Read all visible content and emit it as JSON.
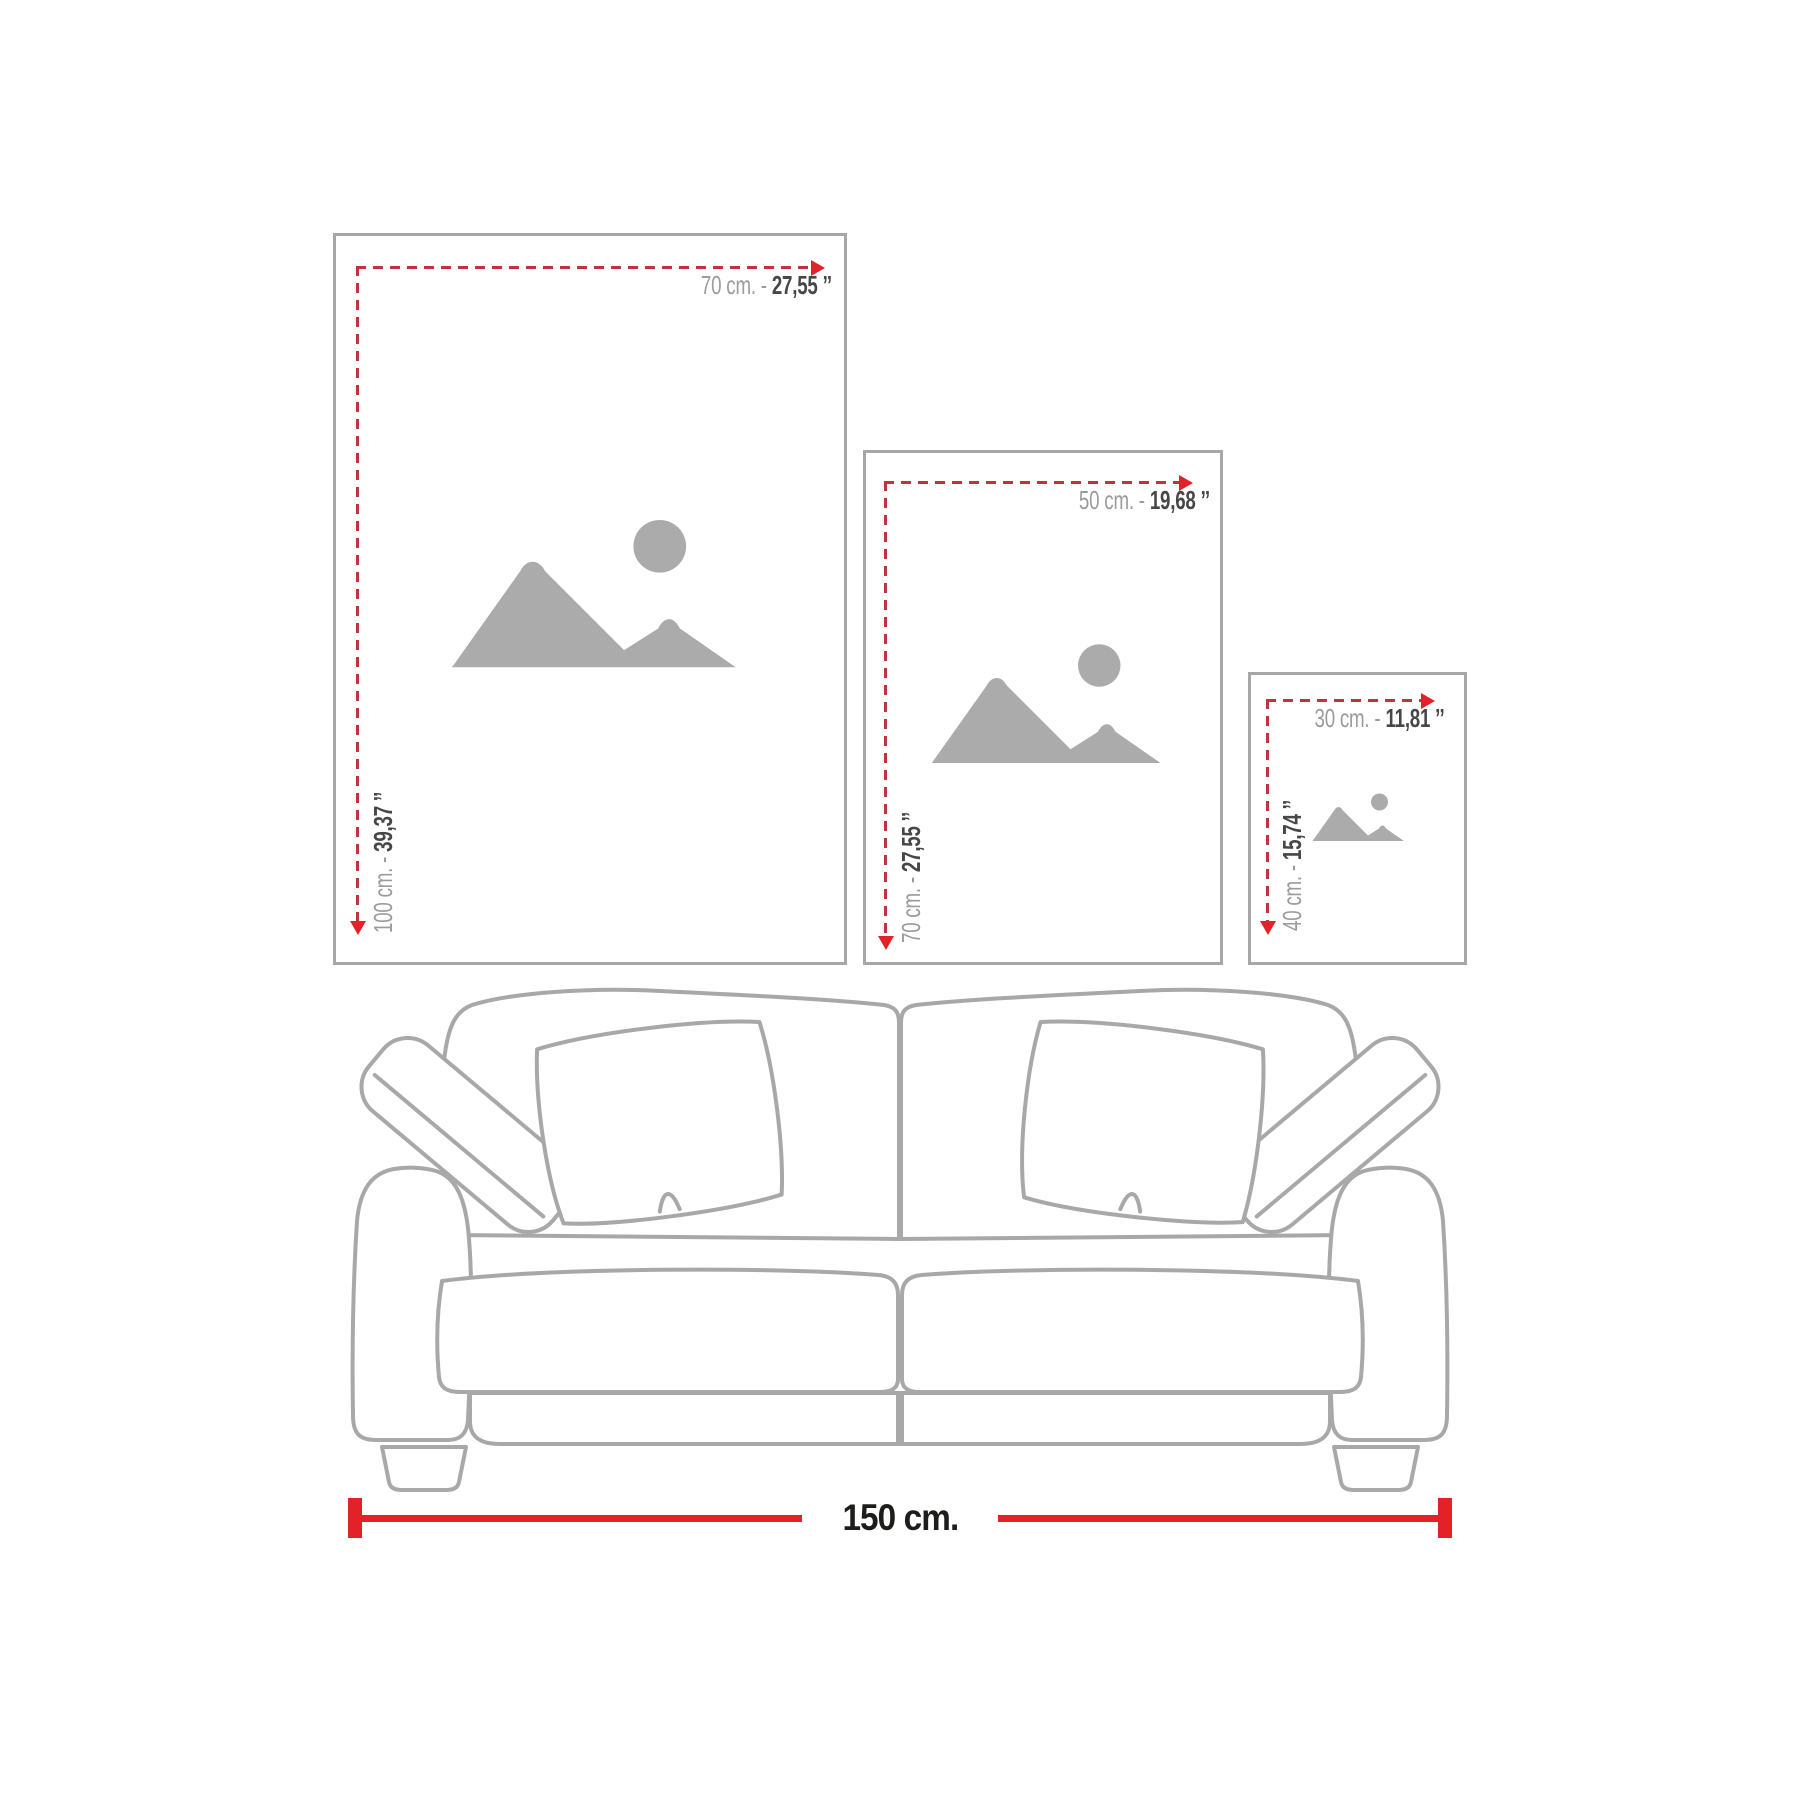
{
  "frames": [
    {
      "name": "frame-70x100",
      "width_cm": "70 cm. -",
      "width_in": "27,55 ’’",
      "height_cm": "100 cm. -",
      "height_in": "39,37 ’’"
    },
    {
      "name": "frame-50x70",
      "width_cm": "50 cm. -",
      "width_in": "19,68 ’’",
      "height_cm": "70 cm. -",
      "height_in": "27,55 ’’"
    },
    {
      "name": "frame-30x40",
      "width_cm": "30 cm. -",
      "width_in": "11,81 ’’",
      "height_cm": "40 cm. -",
      "height_in": "15,74 ’’"
    }
  ],
  "sofa": {
    "width_label": "150 cm."
  },
  "icons": {
    "placeholder": "image-placeholder-icon",
    "arrow_right": "arrow-right-icon",
    "arrow_down": "arrow-down-icon"
  },
  "colors": {
    "frame_border": "#a7a7a7",
    "placeholder_gray": "#ababab",
    "label_gray": "#9b9b9b",
    "label_dark": "#474747",
    "measure_dash": "#c0333a",
    "measure_arrow": "#e32128",
    "measure_red": "#e32128",
    "sofa_line": "#a8a8a8",
    "title_dark": "#1d1d1b"
  }
}
